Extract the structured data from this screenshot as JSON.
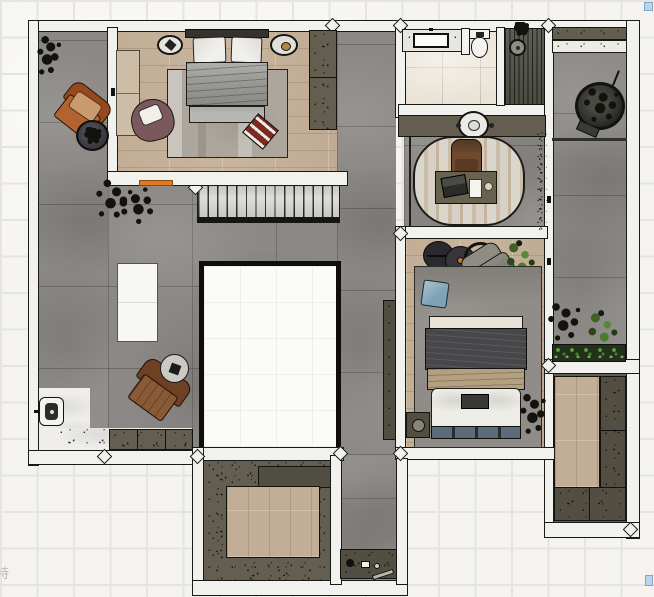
{
  "canvas": {
    "width": 654,
    "height": 597,
    "view": "top-down floor plan render on grid paper"
  },
  "watermark": {
    "text": "特"
  },
  "ui": {
    "selection_handles": [
      {
        "name": "handle-top-right",
        "color": "#bad4ec"
      },
      {
        "name": "handle-bottom-right",
        "color": "#bad4ec"
      }
    ]
  },
  "colors": {
    "paper": "#f4f3f0",
    "grid_line": "#e5e4e0",
    "wall": "#f1f1ee",
    "wall_edge": "#191917",
    "concrete_floor": "#8b8885",
    "wood_floor": "#c8b59d",
    "wood_floor_2": "#c2ae96",
    "bath_tile": "#eae2d5",
    "cabinet_olive": "#635e50",
    "cabinet_dark": "#524e41",
    "accent_orange": "#e0791f",
    "plant_green": "#5a8a3c",
    "handle_blue": "#bad4ec",
    "rug_gray": "#908d88",
    "rug_beige": "#aca69c",
    "stair_tread": "#d8d8d4"
  },
  "scene": {
    "rooms": [
      {
        "name": "bedroom-1",
        "floor": "wood"
      },
      {
        "name": "living-area",
        "floor": "concrete"
      },
      {
        "name": "entry",
        "floor": "marble"
      },
      {
        "name": "bathroom",
        "floor": "tile",
        "features": [
          "vanity-sink",
          "toilet",
          "walk-in-shower"
        ]
      },
      {
        "name": "study-nook",
        "floor": "concrete"
      },
      {
        "name": "bedroom-2",
        "floor": "wood"
      },
      {
        "name": "walk-in-closet",
        "floor": "wood-with-cabinets"
      },
      {
        "name": "terrace",
        "floor": "concrete"
      },
      {
        "name": "storage-room",
        "floor": "wood-with-cabinets"
      },
      {
        "name": "stairwell-void",
        "floor": "open"
      }
    ],
    "furniture": [
      "double-bed-1",
      "rug-bedroom-1",
      "nightstand-left",
      "nightstand-right",
      "wardrobe-1",
      "plum-accent-chair",
      "red-floor-tray",
      "side-desk",
      "orange-armchair",
      "round-side-table-dark",
      "black-plant",
      "tree-silhouette",
      "white-island-table",
      "brown-armchair",
      "round-side-table-light",
      "staircase",
      "shoe-cabinet",
      "wall-intercom",
      "scattered-shoes",
      "vanity-counter",
      "toilet",
      "shower-head",
      "console-cabinet",
      "display-basin",
      "study-desk",
      "office-chair",
      "laptop",
      "notepad",
      "cup",
      "oval-rug",
      "wall-planter-strip",
      "coffee-table-trio",
      "lounge-chair",
      "potted-plant",
      "rug-bedroom-2",
      "blue-pillow",
      "double-bed-2",
      "nightstand-2",
      "bedside-plant",
      "corridor-bookshelf",
      "bar-counter",
      "hanging-chair",
      "planter-dark",
      "planter-green",
      "shrub-bed",
      "storage-cabinets",
      "corridor-shelf"
    ]
  }
}
